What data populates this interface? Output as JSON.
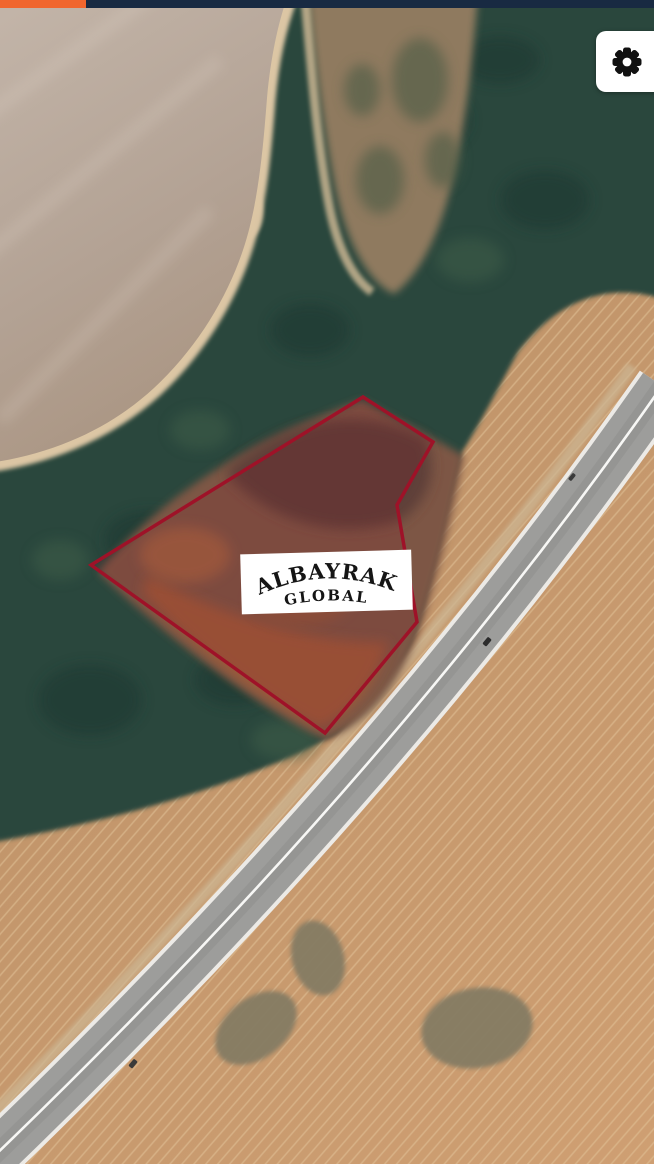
{
  "status_bar": {
    "background_color": "#182a42",
    "accent_color": "#f0662e"
  },
  "map": {
    "view_type": "satellite",
    "watermark": {
      "line1": "ALBAYRAK",
      "line2": "GLOBAL",
      "background_color": "#ffffff",
      "text_color": "#151515"
    },
    "parcel_overlay": {
      "points": "91,565 363,397 433,442 397,505 417,622 325,733",
      "stroke_color": "#9e1228",
      "fill_color": "rgba(130,20,40,0.16)"
    },
    "settings_button": {
      "icon": "gear-icon",
      "background_color": "#ffffff",
      "icon_color": "#111111"
    },
    "terrain": {
      "water_color": "#b5a79a",
      "sand_color": "#dcc6a4",
      "forest_color": "#2b463c",
      "field_color": "#c49a6f",
      "furrow_color": "#e2c298",
      "soil_color": "#7d5645",
      "road_color": "#9d9d9b",
      "road_line_color": "#f7f7f5"
    }
  }
}
